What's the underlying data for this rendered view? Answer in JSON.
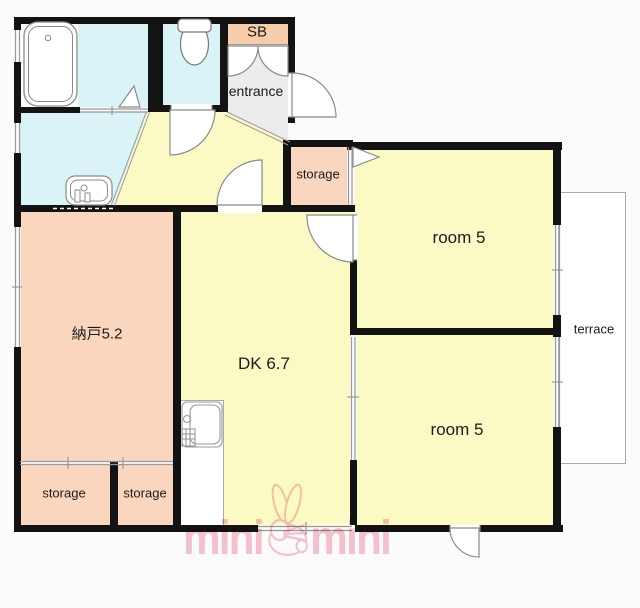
{
  "title": "apartment floor plan",
  "colors": {
    "background": "#fbfbfb",
    "room_yellow": "#fbf9c4",
    "room_peach": "#f9d6bd",
    "sb_peach": "#f8cda9",
    "wet_blue": "#d9f3f6",
    "entrance_gray": "#ececec",
    "wall_black": "#131313",
    "line_gray": "#999999",
    "watermark_pink": "#f2a0b2",
    "text": "#1c1c1c"
  },
  "rooms": {
    "sb": "SB",
    "entrance": "entrance",
    "storage_top": "storage",
    "room5_top": "room 5",
    "terrace": "terrace",
    "nando": "納戸5.2",
    "dk": "DK 6.7",
    "room5_bottom": "room 5",
    "storage_bottom_left": "storage",
    "storage_bottom_right": "storage"
  },
  "watermark": {
    "word_left": "mini",
    "word_right": "mini"
  }
}
